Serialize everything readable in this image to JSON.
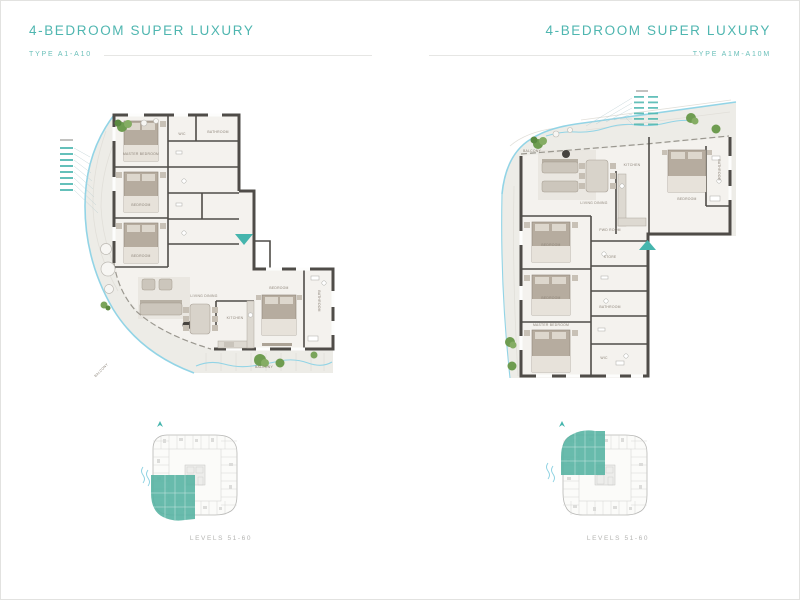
{
  "page": {
    "background": "#ffffff",
    "border_color": "#e2e2e0"
  },
  "colors": {
    "title_teal": "#4fb6b0",
    "accent_teal": "#45b5ad",
    "highlight_teal": "#58b4a3",
    "water_blue": "#92d4e6",
    "wall_dark": "#4f4c48",
    "balcony_floor": "#edece7",
    "room_floor": "#f4f2ee",
    "keyplan_gray": "#b6b6b4"
  },
  "left_panel": {
    "title": "4-BEDROOM SUPER LUXURY",
    "type_label": "TYPE A1-A10",
    "levels_caption": "LEVELS 51-60",
    "rooms": {
      "master_bedroom": "MASTER BEDROOM",
      "bedroom": "BEDROOM",
      "living_dining": "LIVING DINING",
      "kitchen": "KITCHEN",
      "balcony": "BALCONY",
      "bathroom": "BATHROOM",
      "wic": "WIC"
    }
  },
  "right_panel": {
    "title": "4-BEDROOM SUPER LUXURY",
    "type_label": "TYPE A1M-A10M",
    "levels_caption": "LEVELS 51-60",
    "rooms": {
      "master_bedroom": "MASTER BEDROOM",
      "bedroom": "BEDROOM",
      "living_dining": "LIVING DINING",
      "kitchen": "KITCHEN",
      "balcony": "BALCONY",
      "bathroom": "BATHROOM",
      "wic": "WIC",
      "store": "STORE",
      "pwd_room": "PWD ROOM"
    }
  },
  "icons": {
    "entry_marker": "entry-direction-triangle",
    "north_arrow": "north-arrow",
    "water_marks": "water-waves"
  }
}
